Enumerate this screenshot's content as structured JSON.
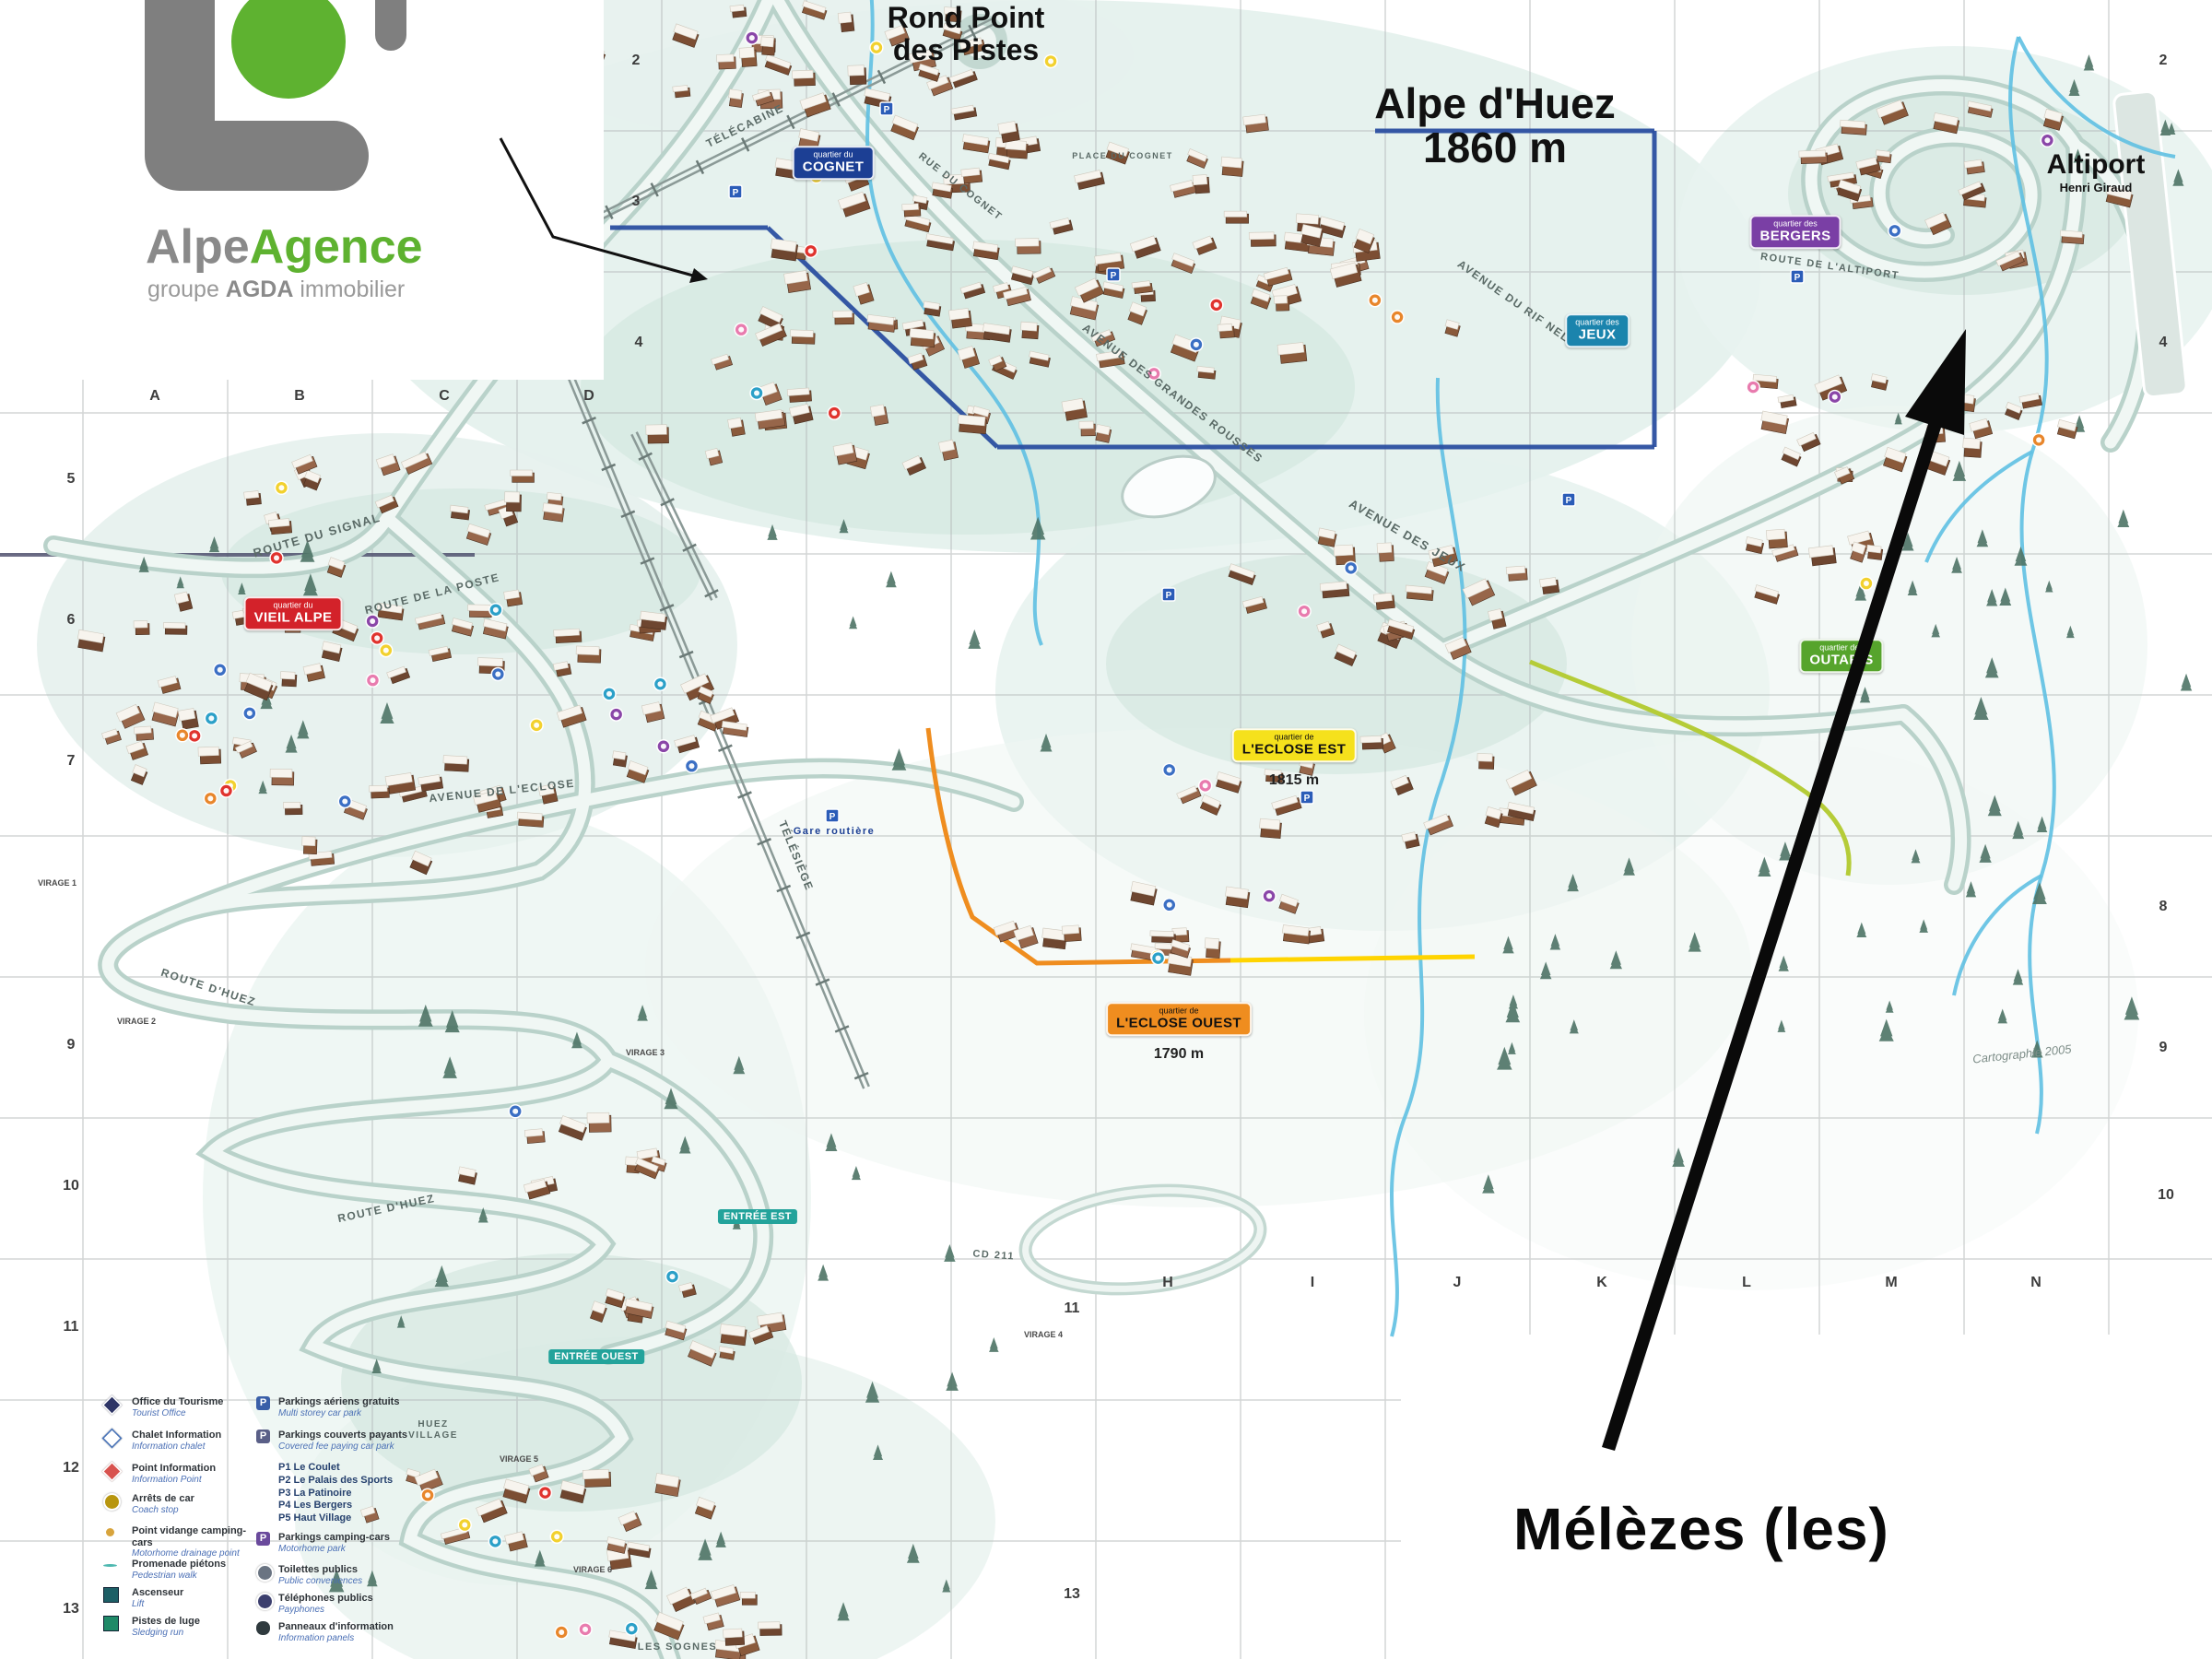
{
  "logo": {
    "word_gray": "Alpe",
    "word_green": "Agence",
    "subtitle_pre": "groupe ",
    "subtitle_bold": "AGDA",
    "subtitle_post": " immobilier",
    "gray": "#8a8a8a",
    "green": "#5eb230"
  },
  "titles": {
    "rond_point_line1": "Rond Point",
    "rond_point_line2": "des Pistes",
    "resort_name": "Alpe d'Huez",
    "resort_altitude": "1860 m",
    "altiport": "Altiport",
    "altiport_sub": "Henri Giraud",
    "callout": "Mélèzes (les)",
    "credit": "Cartographie 2005"
  },
  "quarters": [
    {
      "prefix": "quartier du",
      "name": "COGNET",
      "color": "#1c3f94",
      "text": "#ffffff"
    },
    {
      "prefix": "quartier des",
      "name": "BERGERS",
      "color": "#7a3fa5",
      "text": "#ffffff"
    },
    {
      "prefix": "quartier des",
      "name": "JEUX",
      "color": "#1b84ad",
      "text": "#ffffff"
    },
    {
      "prefix": "quartier du",
      "name": "VIEIL ALPE",
      "color": "#d3222a",
      "text": "#ffffff"
    },
    {
      "prefix": "quartier de",
      "name": "L'ECLOSE EST",
      "color": "#f5e11c",
      "text": "#111111",
      "altitude": "1815 m"
    },
    {
      "prefix": "quartier de",
      "name": "L'ECLOSE OUEST",
      "color": "#ef8d1f",
      "text": "#111111",
      "altitude": "1790 m"
    },
    {
      "prefix": "quartier des",
      "name": "OUTARIS",
      "color": "#56a42c",
      "text": "#ffffff"
    }
  ],
  "entrances": [
    {
      "label": "ENTRÉE EST"
    },
    {
      "label": "ENTRÉE OUEST"
    }
  ],
  "grid": {
    "letters": [
      "A",
      "B",
      "C",
      "D",
      "H",
      "I",
      "J",
      "K",
      "L",
      "M",
      "N"
    ],
    "numbers": [
      "2",
      "3",
      "4",
      "5",
      "6",
      "7",
      "8",
      "9",
      "10",
      "11",
      "12",
      "13"
    ]
  },
  "streets": [
    {
      "label": "ROUTE DU SIGNAL"
    },
    {
      "label": "ROUTE DE LA POSTE"
    },
    {
      "label": "AVENUE DE L'ECLOSE"
    },
    {
      "label": "ROUTE D'HUEZ"
    },
    {
      "label": "ROUTE D'HUEZ"
    },
    {
      "label": "AVENUE DES JEUX"
    },
    {
      "label": "AVENUE DES GRANDES ROUSSES"
    },
    {
      "label": "AVENUE DU RIF NEL"
    },
    {
      "label": "RUE DU COGNET"
    },
    {
      "label": "ROUTE DE L'ALTIPORT"
    },
    {
      "label": "TÉLÉSIÈGE"
    },
    {
      "label": "TÉLÉCABINE"
    },
    {
      "label": "CD 211"
    },
    {
      "label": "Gare routière"
    },
    {
      "label": "PLACE DU COGNET"
    },
    {
      "label": "HUEZ"
    },
    {
      "label": "VILLAGE"
    },
    {
      "label": "LES SOGNES"
    }
  ],
  "virages": [
    {
      "label": "VIRAGE 1"
    },
    {
      "label": "VIRAGE 2"
    },
    {
      "label": "VIRAGE 3"
    },
    {
      "label": "VIRAGE 4"
    },
    {
      "label": "VIRAGE 5"
    },
    {
      "label": "VIRAGE 6"
    }
  ],
  "legend": {
    "left": [
      {
        "fr": "Office du Tourisme",
        "en": "Tourist Office",
        "icon": "diamond",
        "color": "#2e3566"
      },
      {
        "fr": "Chalet Information",
        "en": "Information chalet",
        "icon": "diamond",
        "color": "#ffffff"
      },
      {
        "fr": "Point Information",
        "en": "Information Point",
        "icon": "diamond",
        "color": "#d8524e"
      },
      {
        "fr": "Arrêts de car",
        "en": "Coach stop",
        "icon": "circle",
        "color": "#b8960f"
      },
      {
        "fr": "Point vidange camping-cars",
        "en": "Motorhome drainage point",
        "icon": "dot",
        "color": "#d8a43c"
      },
      {
        "fr": "Promenade piétons",
        "en": "Pedestrian walk",
        "icon": "wave",
        "color": "#4db8b0"
      },
      {
        "fr": "Ascenseur",
        "en": "Lift",
        "icon": "square",
        "color": "#1d5f66"
      },
      {
        "fr": "Pistes de luge",
        "en": "Sledging run",
        "icon": "square",
        "color": "#1f8a68"
      }
    ],
    "right": [
      {
        "fr": "Parkings aériens gratuits",
        "en": "Multi storey car park",
        "icon": "P",
        "color": "#3a5fa8"
      },
      {
        "fr": "Parkings couverts payants",
        "en": "Covered fee paying car park",
        "icon": "P",
        "color": "#5a5f87"
      },
      {
        "fr": "Parkings camping-cars",
        "en": "Motorhome park",
        "icon": "P",
        "color": "#6a4a9c"
      },
      {
        "fr": "Toilettes publics",
        "en": "Public conveniences",
        "icon": "circle",
        "color": "#6a7482"
      },
      {
        "fr": "Téléphones publics",
        "en": "Payphones",
        "icon": "circle",
        "color": "#3c3f6e"
      },
      {
        "fr": "Panneaux d'information",
        "en": "Information panels",
        "icon": "pill",
        "color": "#2f3a3e"
      }
    ],
    "parking_list": "P1  Le Coulet\nP2  Le Palais des Sports\nP3  La Patinoire\nP4  Les Bergers\nP5  Haut Village"
  }
}
